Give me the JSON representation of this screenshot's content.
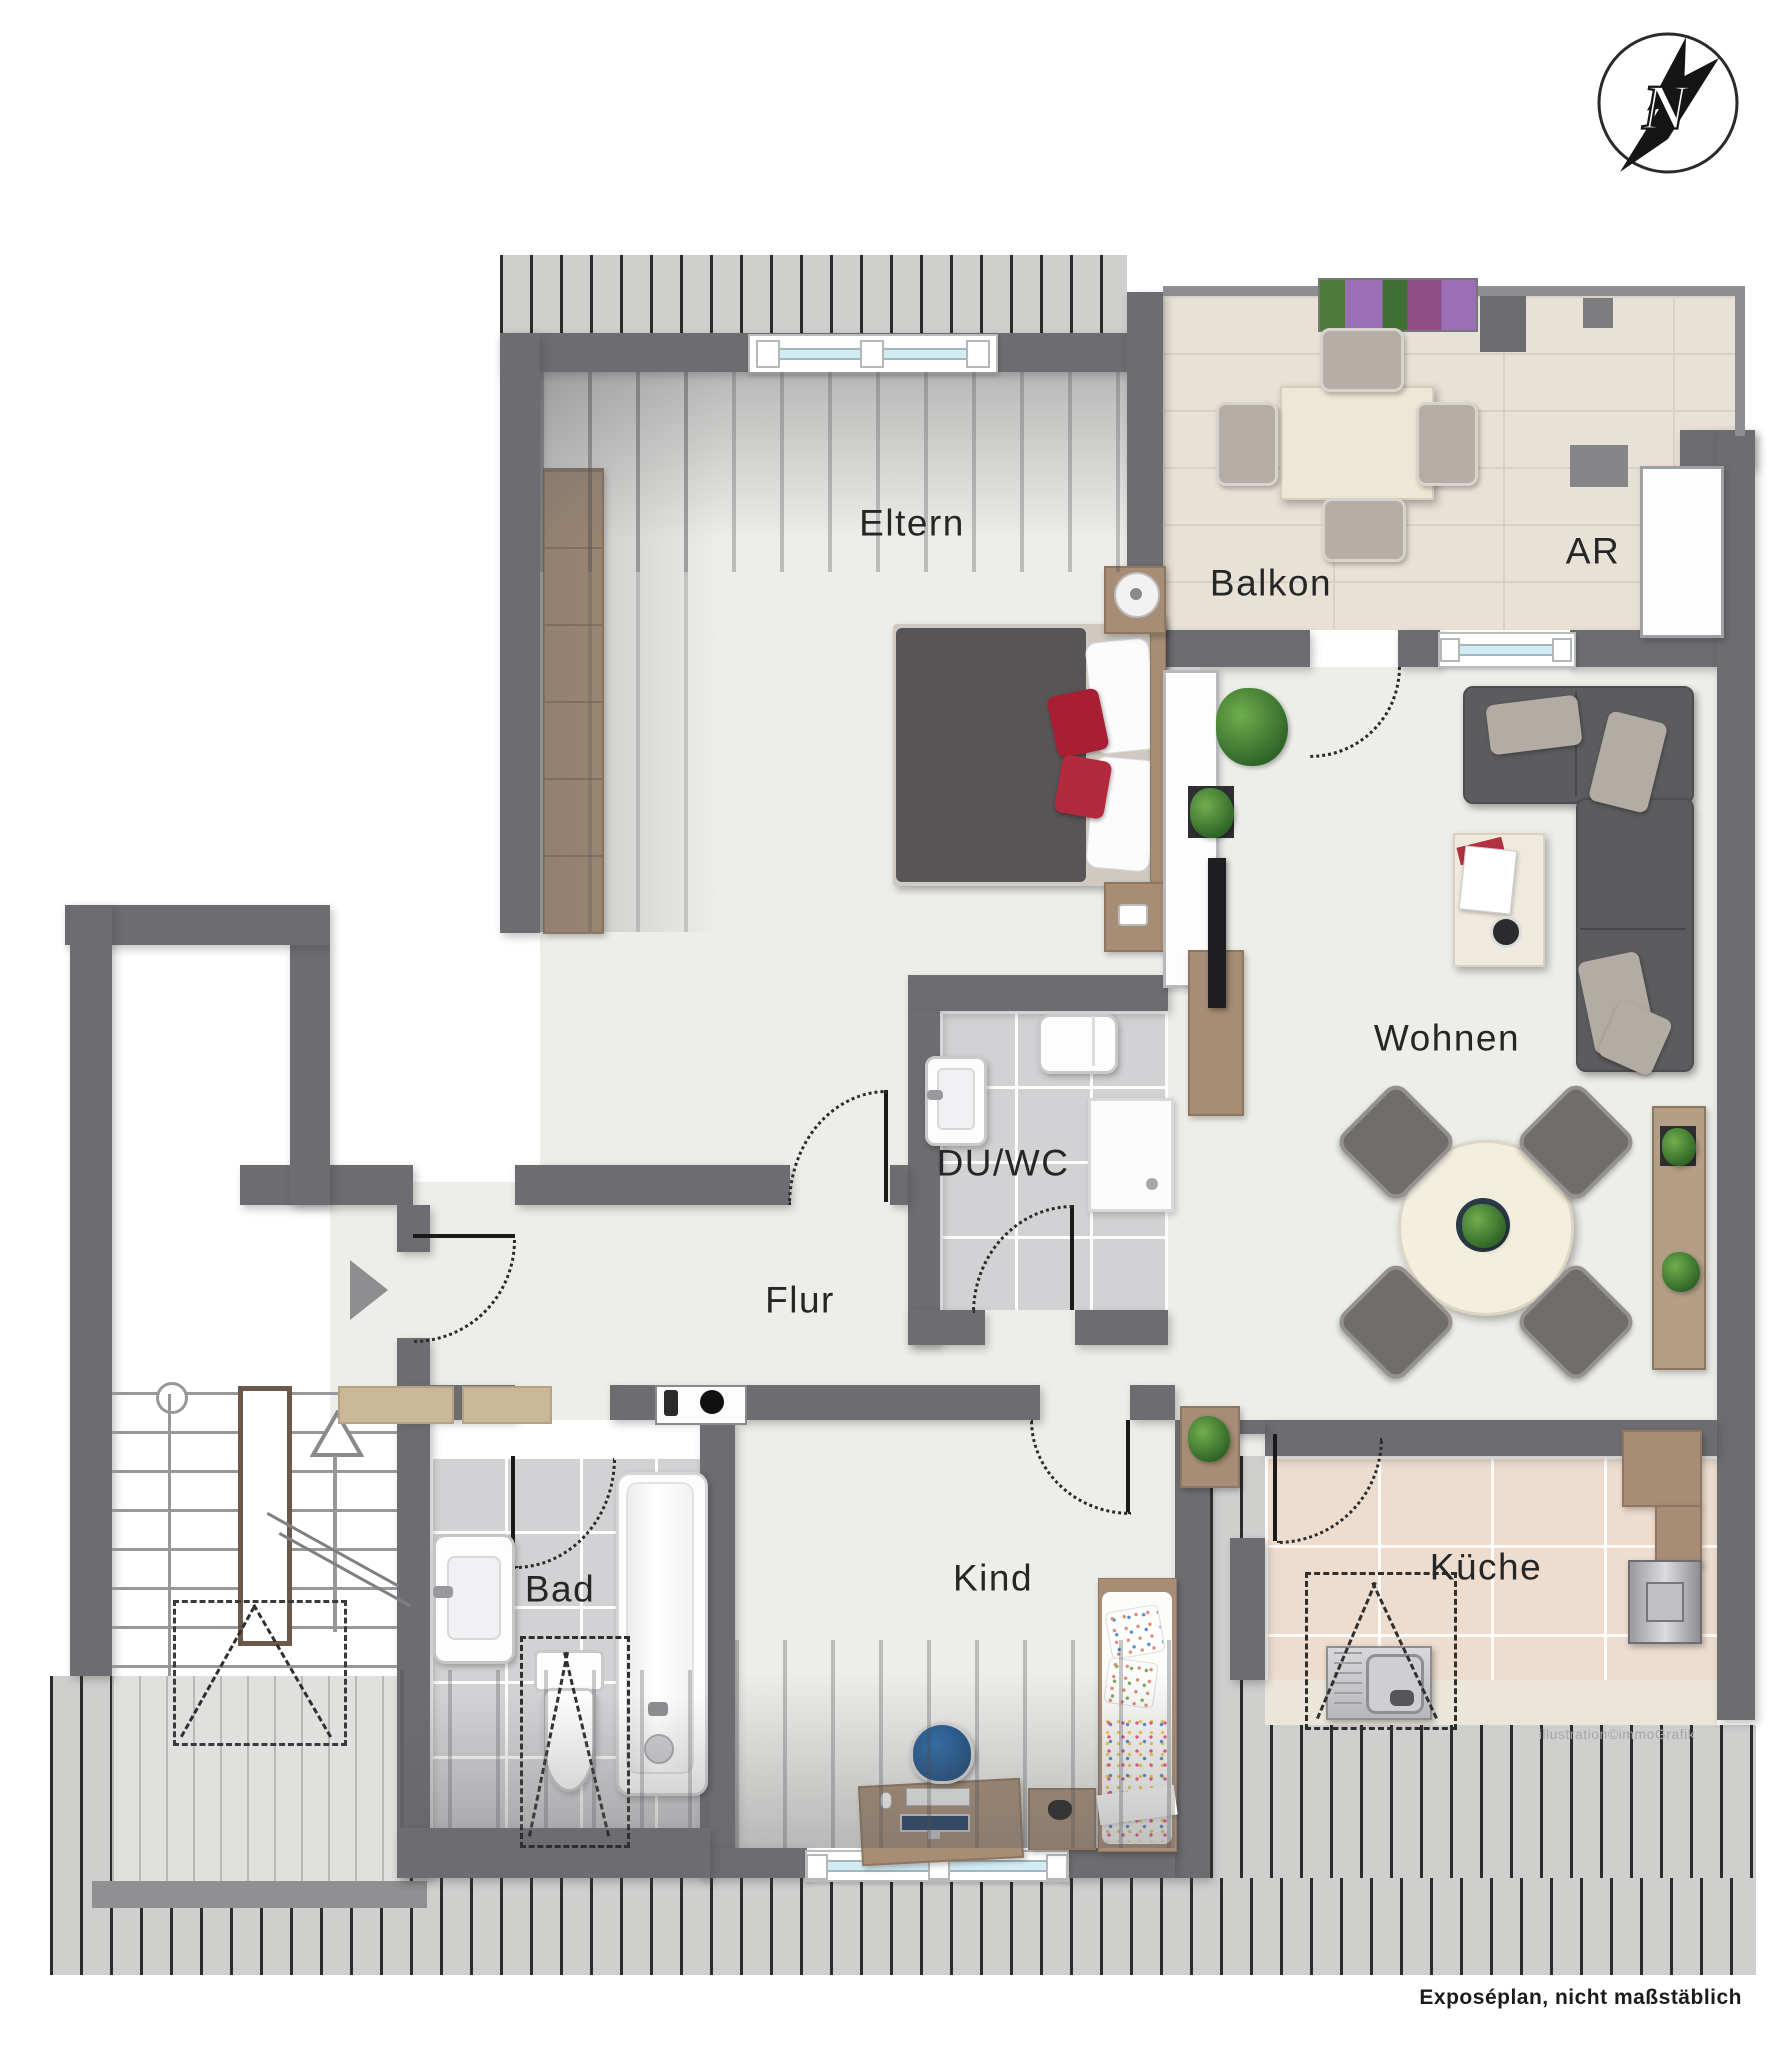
{
  "labels": {
    "eltern": "Eltern",
    "balkon": "Balkon",
    "ar": "AR",
    "wohnen": "Wohnen",
    "du_wc": "DU/WC",
    "flur": "Flur",
    "bad": "Bad",
    "kind": "Kind",
    "kueche": "Küche"
  },
  "annotations": {
    "watermark": "illustration©immoGrafik",
    "footer": "Exposéplan, nicht maßstäblich"
  },
  "compass": {
    "icon": "north-arrow-icon",
    "letter": "N"
  },
  "icons": {
    "compass": "north-arrow-icon",
    "entrance": "entrance-arrow-icon",
    "stairs_direction": "stairs-up-arrow-icon"
  },
  "colors": {
    "wall": "#6d6d71",
    "room_floor": "#edeeea",
    "bath_tile": "#d2d2d4",
    "kitchen_tile": "#eedccf",
    "balcony_tile": "#e7e1d6",
    "wood": "#a78d75",
    "sofa": "#5c5c5f",
    "accent_red": "#a81f33",
    "window_glazing": "#d3ecf3",
    "hatch_background": "#cfcfce"
  }
}
